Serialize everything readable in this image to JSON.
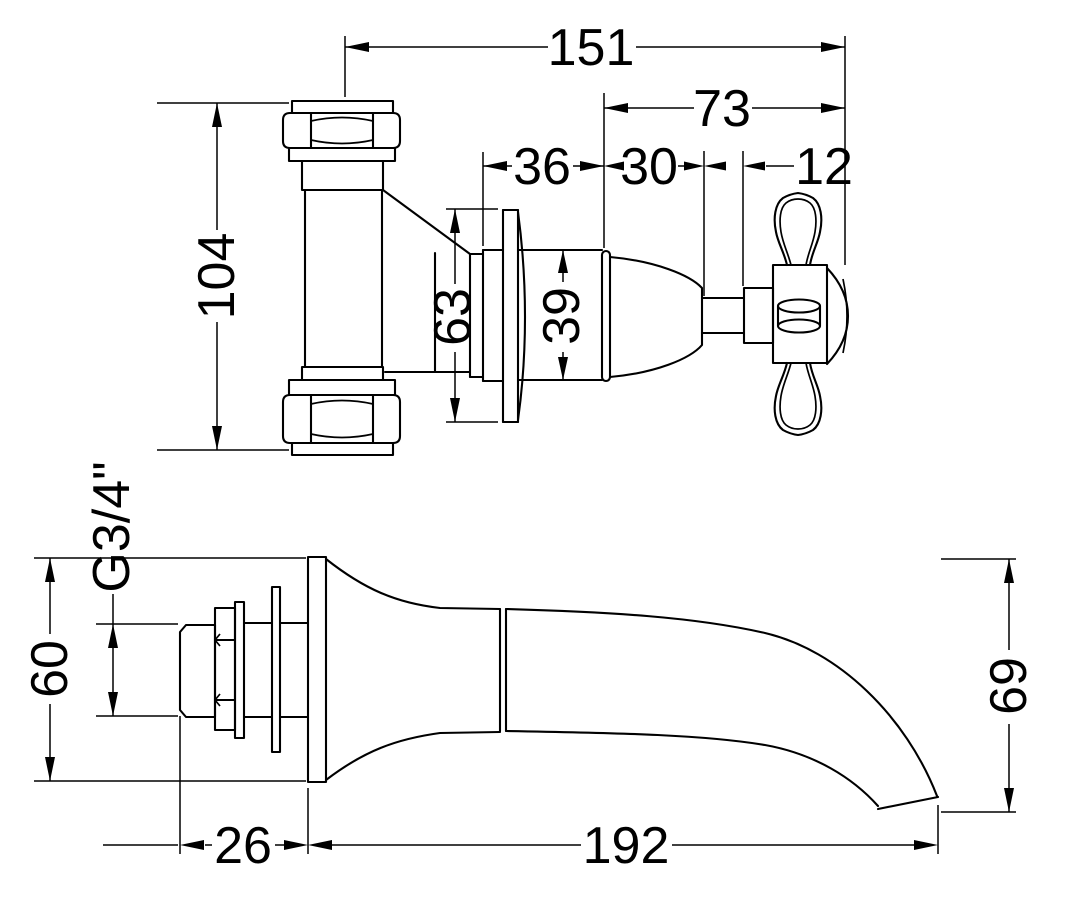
{
  "dimensions": {
    "overall_projection": "151",
    "handle_projection": "73",
    "flange_to_head": "36",
    "head_length": "30",
    "spindle_length": "12",
    "tee_height": "104",
    "flange_diameter": "63",
    "head_diameter": "39",
    "thread_size": "G3/4\"",
    "backplate_diameter": "60",
    "tail_length": "26",
    "spout_reach": "192",
    "spout_drop": "69"
  }
}
